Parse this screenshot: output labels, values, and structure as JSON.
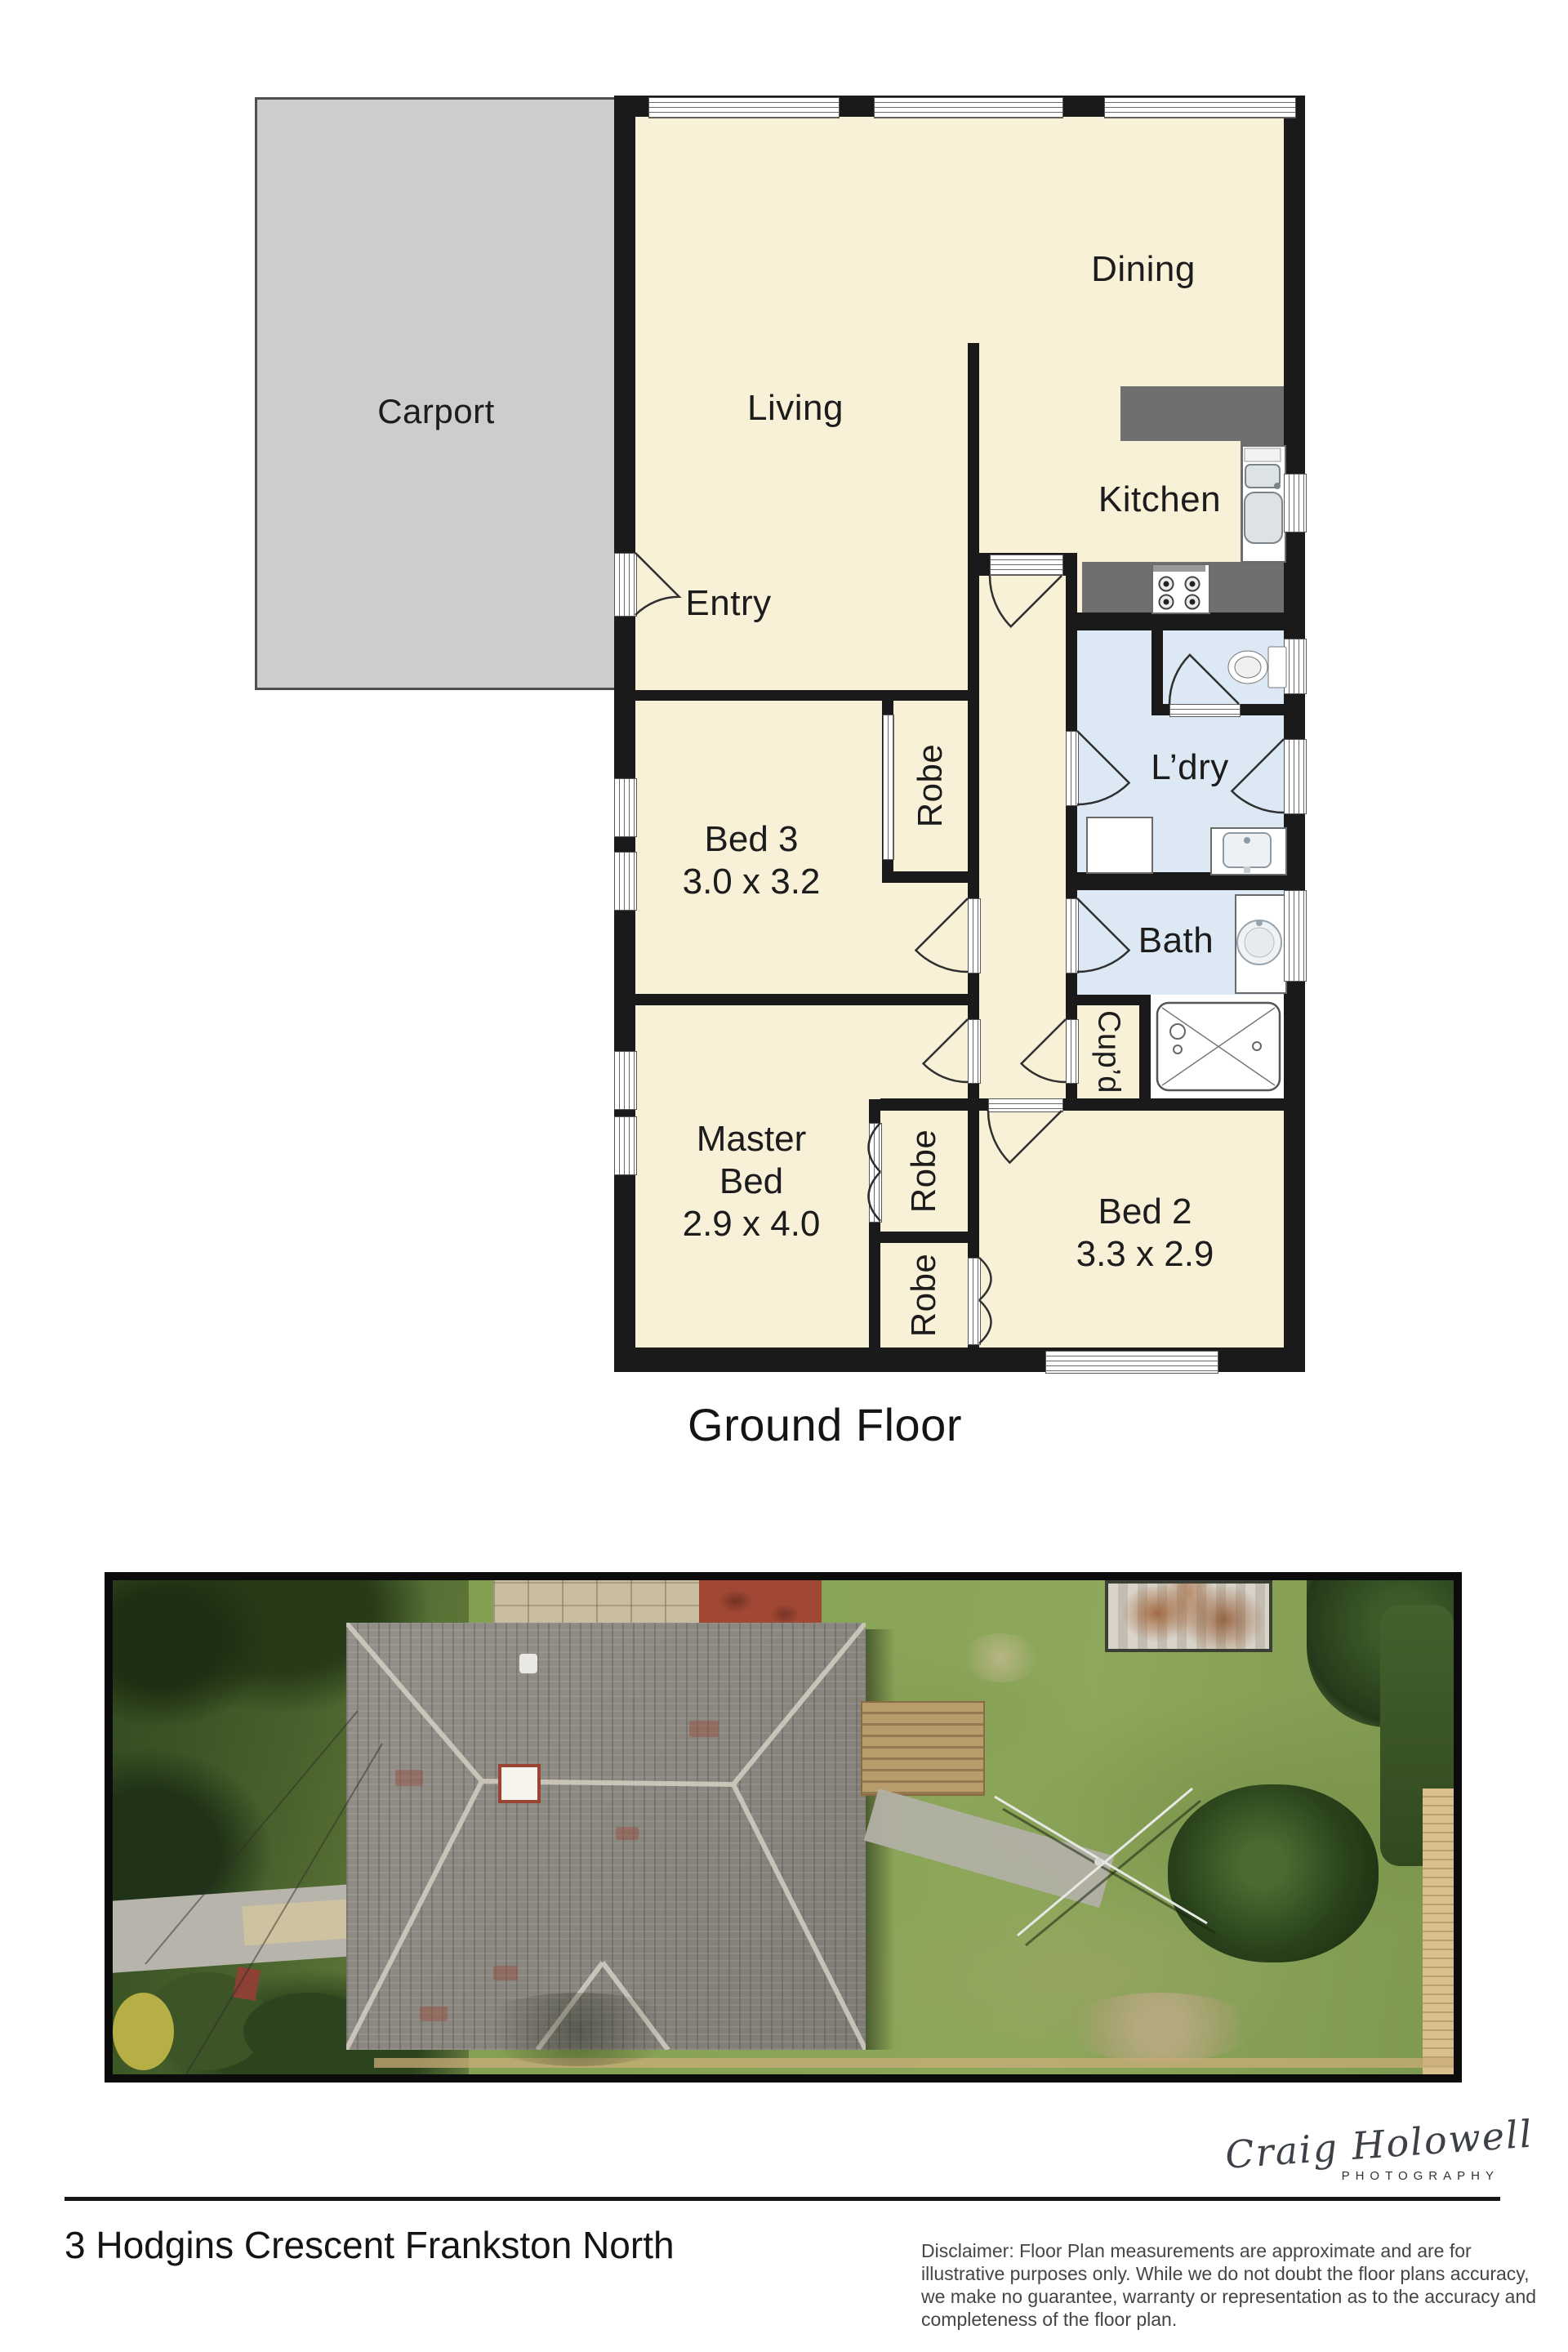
{
  "floorplan": {
    "caption": "Ground Floor",
    "labels": {
      "carport": "Carport",
      "living": "Living",
      "dining": "Dining",
      "kitchen": "Kitchen",
      "entry": "Entry",
      "bed3_name": "Bed 3",
      "bed3_dims": "3.0 x 3.2",
      "robe": "Robe",
      "laundry": "L’dry",
      "bath": "Bath",
      "cupboard": "Cup’d",
      "master_line1": "Master",
      "master_line2": "Bed",
      "master_dims": "2.9 x 4.0",
      "bed2_name": "Bed 2",
      "bed2_dims": "3.3 x 2.9"
    },
    "colors": {
      "floor": "#f9f0d8",
      "wet_area_floor": "#dce8f3",
      "wall": "#1a1a1a",
      "bench": "#6f6f6f",
      "carport_fill": "#cdcdcd"
    }
  },
  "signature": {
    "name": "Craig Holowell",
    "subtitle": "PHOTOGRAPHY"
  },
  "footer": {
    "address": "3 Hodgins Crescent Frankston North",
    "disclaimer_lines": [
      "Disclaimer: Floor Plan measurements are approximate and are for",
      "illustrative purposes only. While we do not doubt the floor plans accuracy,",
      "we make no guarantee, warranty or representation as to the accuracy and",
      "completeness of the floor plan."
    ]
  }
}
